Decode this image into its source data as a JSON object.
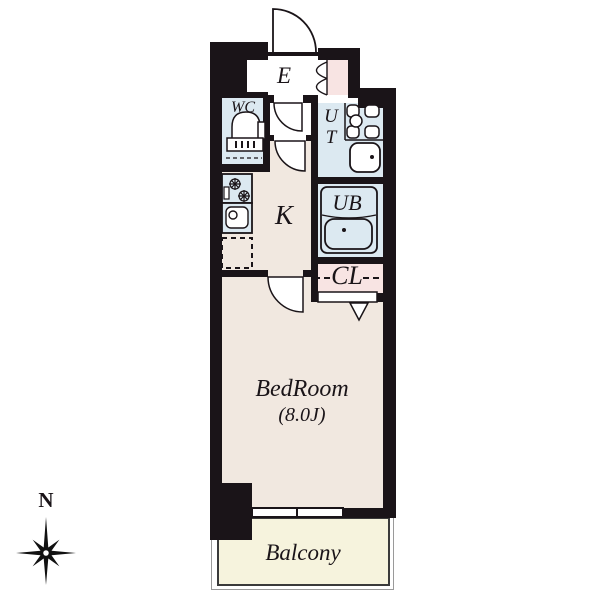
{
  "plan_title": "apartment-floor-plan",
  "compass": {
    "north_label": "N"
  },
  "rooms": {
    "entrance": {
      "label": "E"
    },
    "wc": {
      "label": "WC"
    },
    "utility": {
      "label_line1": "U",
      "label_line2": "T"
    },
    "unit_bath": {
      "label": "UB"
    },
    "kitchen": {
      "label": "K"
    },
    "closet": {
      "label": "CL"
    },
    "bedroom": {
      "label": "BedRoom",
      "size": "(8.0J)"
    },
    "balcony": {
      "label": "Balcony"
    }
  },
  "colors": {
    "wall": "#1a1418",
    "wet_area_blue": "#dce9f1",
    "closet_pink": "#f8e4e3",
    "floor_beige": "#f1e8e0",
    "balcony_cream": "#f6f3dd",
    "background": "#ffffff"
  },
  "icons": [
    "compass-rose-icon",
    "toilet-icon",
    "stove-icon",
    "kitchen-sink-icon",
    "laundry-counter-icon",
    "washbasin-icon",
    "bathtub-icon",
    "window-icon",
    "entrance-door-swing-icon",
    "hallway-door-swing-icon",
    "kitchen-door-swing-icon",
    "bedroom-door-swing-icon",
    "cabinet-double-door-icon",
    "closet-door-arrow-icon",
    "fridge-space-dashed-icon",
    "closet-rod-dash-icon"
  ]
}
